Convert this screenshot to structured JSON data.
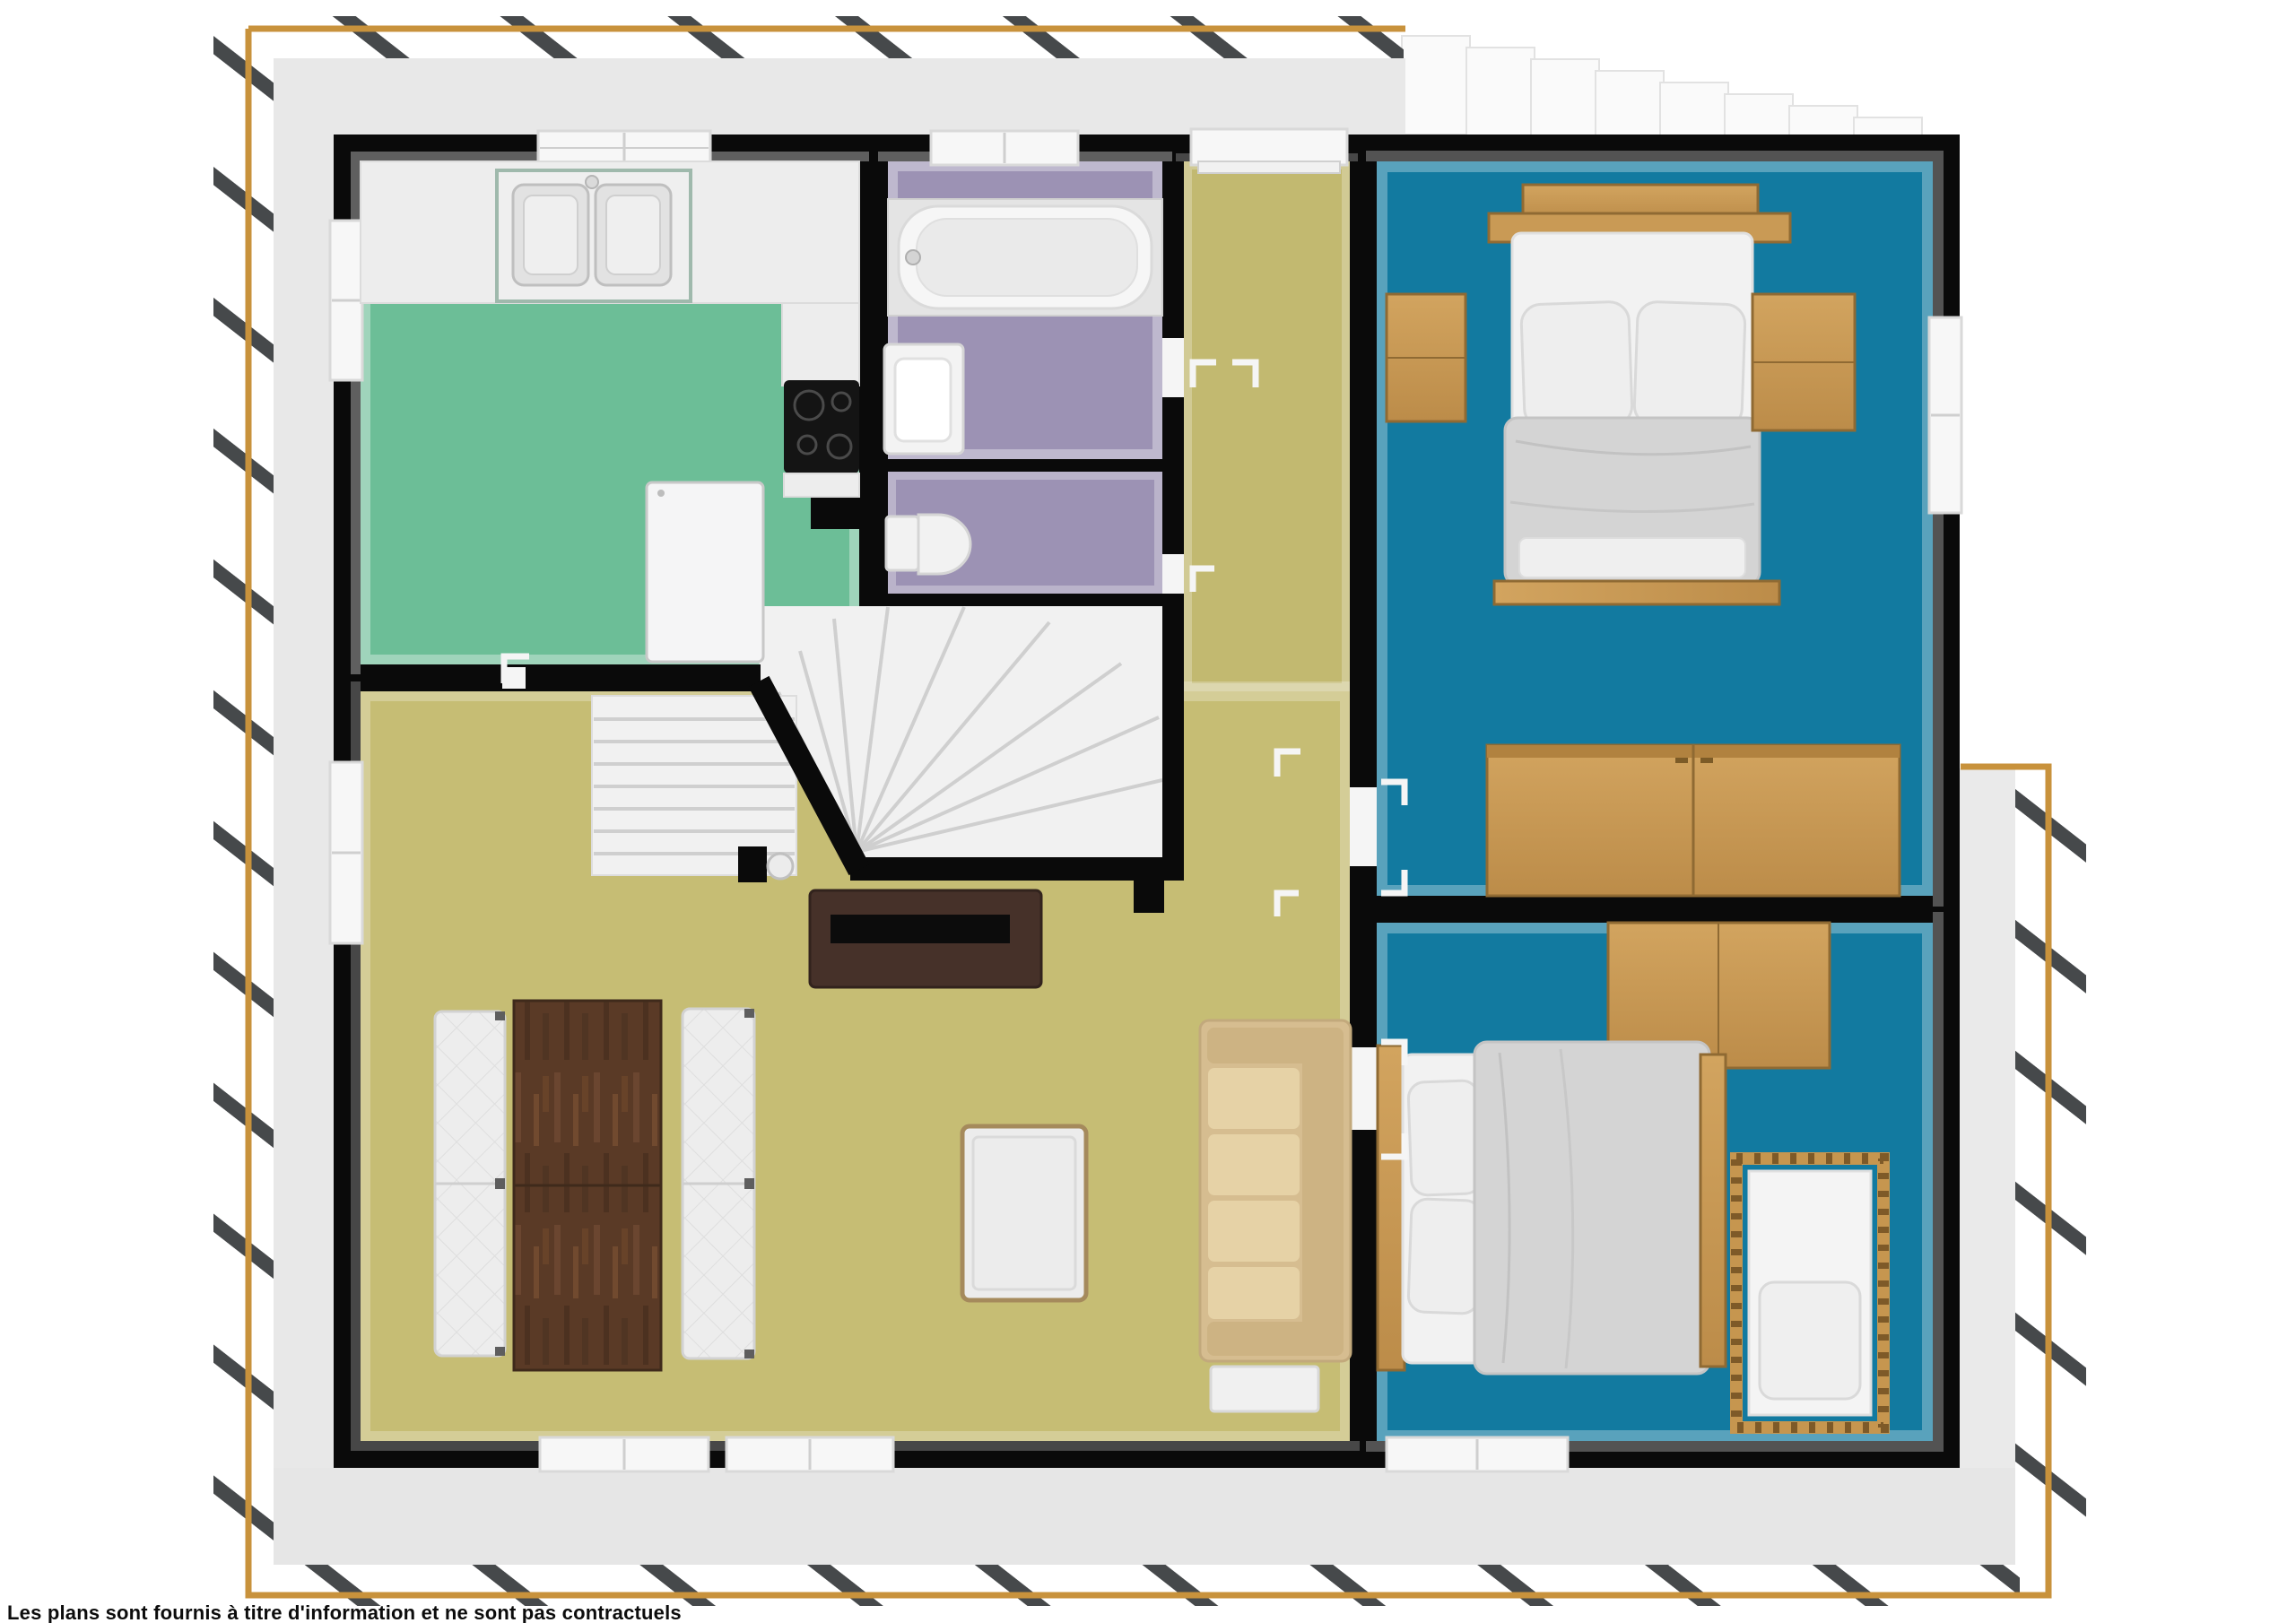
{
  "disclaimer": "Les plans sont fournis à titre d'information et ne sont pas contractuels",
  "palette": {
    "plot_border": "#C8923C",
    "hatch_marks": "#46494B",
    "facade_band": "#E8E8E8",
    "walls": "#0A0A0A",
    "kitchen_floor": "#6CBE97",
    "bathroom_floor": "#9C92B4",
    "wc_floor": "#9C92B4",
    "hallway_floor": "#C2B970",
    "living_floor": "#C6BD74",
    "bedroom_floor": "#127AA0",
    "wood_light": "#C9995A",
    "wood_table_dark": "#5A3A26",
    "tv_stand": "#463129",
    "sofa_beige": "#D6BD90",
    "bedding_gray": "#D4D4D4",
    "stairs": "#F1F1F1"
  },
  "plan": {
    "type": "floor-plan-top-view-3d-render",
    "floor_note": "upper floor with stair opening",
    "rooms": [
      {
        "id": "kitchen",
        "floor_color": "#6CBE97",
        "contents": [
          "counter with double sink",
          "skylight window",
          "cooktop 4 burners",
          "fridge",
          "left wall window"
        ]
      },
      {
        "id": "bathroom",
        "floor_color": "#9C92B4",
        "contents": [
          "bathtub with deck",
          "skylight window",
          "washbasin"
        ]
      },
      {
        "id": "wc",
        "floor_color": "#9C92B4",
        "contents": [
          "toilet"
        ]
      },
      {
        "id": "hallway",
        "floor_color": "#C6BD74",
        "contents": [
          "entry door at top wall",
          "door marks"
        ]
      },
      {
        "id": "staircase",
        "floor_color": "#F1F1F1",
        "contents": [
          "straight flight",
          "winder flight",
          "railing walls"
        ]
      },
      {
        "id": "living-room",
        "floor_color": "#C6BD74",
        "contents": [
          "dining table dark wood",
          "two white quilted benches",
          "tv stand with tv",
          "beige sofa",
          "coffee table",
          "two bottom windows",
          "left wall window"
        ]
      },
      {
        "id": "bedroom-1",
        "floor_color": "#127AA0",
        "contents": [
          "double bed with two pillows",
          "headboard shelf",
          "nightstand left",
          "nightstand right",
          "large wardrobe",
          "right wall window"
        ]
      },
      {
        "id": "bedroom-2",
        "floor_color": "#127AA0",
        "contents": [
          "double bed with two pillows",
          "crib with slats",
          "wall cabinet",
          "nightstand",
          "bottom window"
        ]
      }
    ]
  }
}
